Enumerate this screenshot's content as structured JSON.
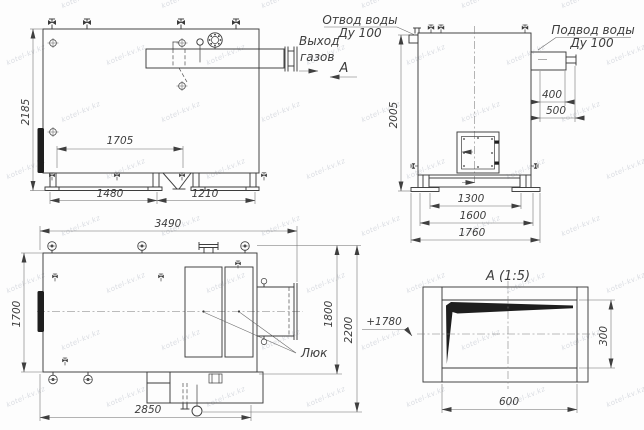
{
  "watermark": {
    "text": "kotel-kv.kz"
  },
  "front_view": {
    "gas_outlet_label_line1": "Выход",
    "gas_outlet_label_line2": "газов",
    "dims": {
      "height": "2185",
      "inner_span": "1705",
      "skid_left": "1480",
      "skid_right": "1210"
    }
  },
  "side_view": {
    "water_outlet_line1": "Отвод воды",
    "water_outlet_line2": "Ду 100",
    "water_inlet_line1": "Подвод воды",
    "water_inlet_line2": "Ду 100",
    "view_arrow_label": "А",
    "dims": {
      "height": "2005",
      "nozzle_a": "400",
      "nozzle_b": "500",
      "base_inner": "1300",
      "base_mid": "1600",
      "base_outer": "1760"
    }
  },
  "top_view": {
    "hatch_label": "Люк",
    "elevation": "+1780",
    "dims": {
      "length": "3490",
      "width": "1700",
      "offset_a": "1800",
      "offset_b": "2200",
      "bottom_length": "2850"
    }
  },
  "detail_view": {
    "title": "А (1:5)",
    "dims": {
      "width": "600",
      "height": "300"
    }
  }
}
